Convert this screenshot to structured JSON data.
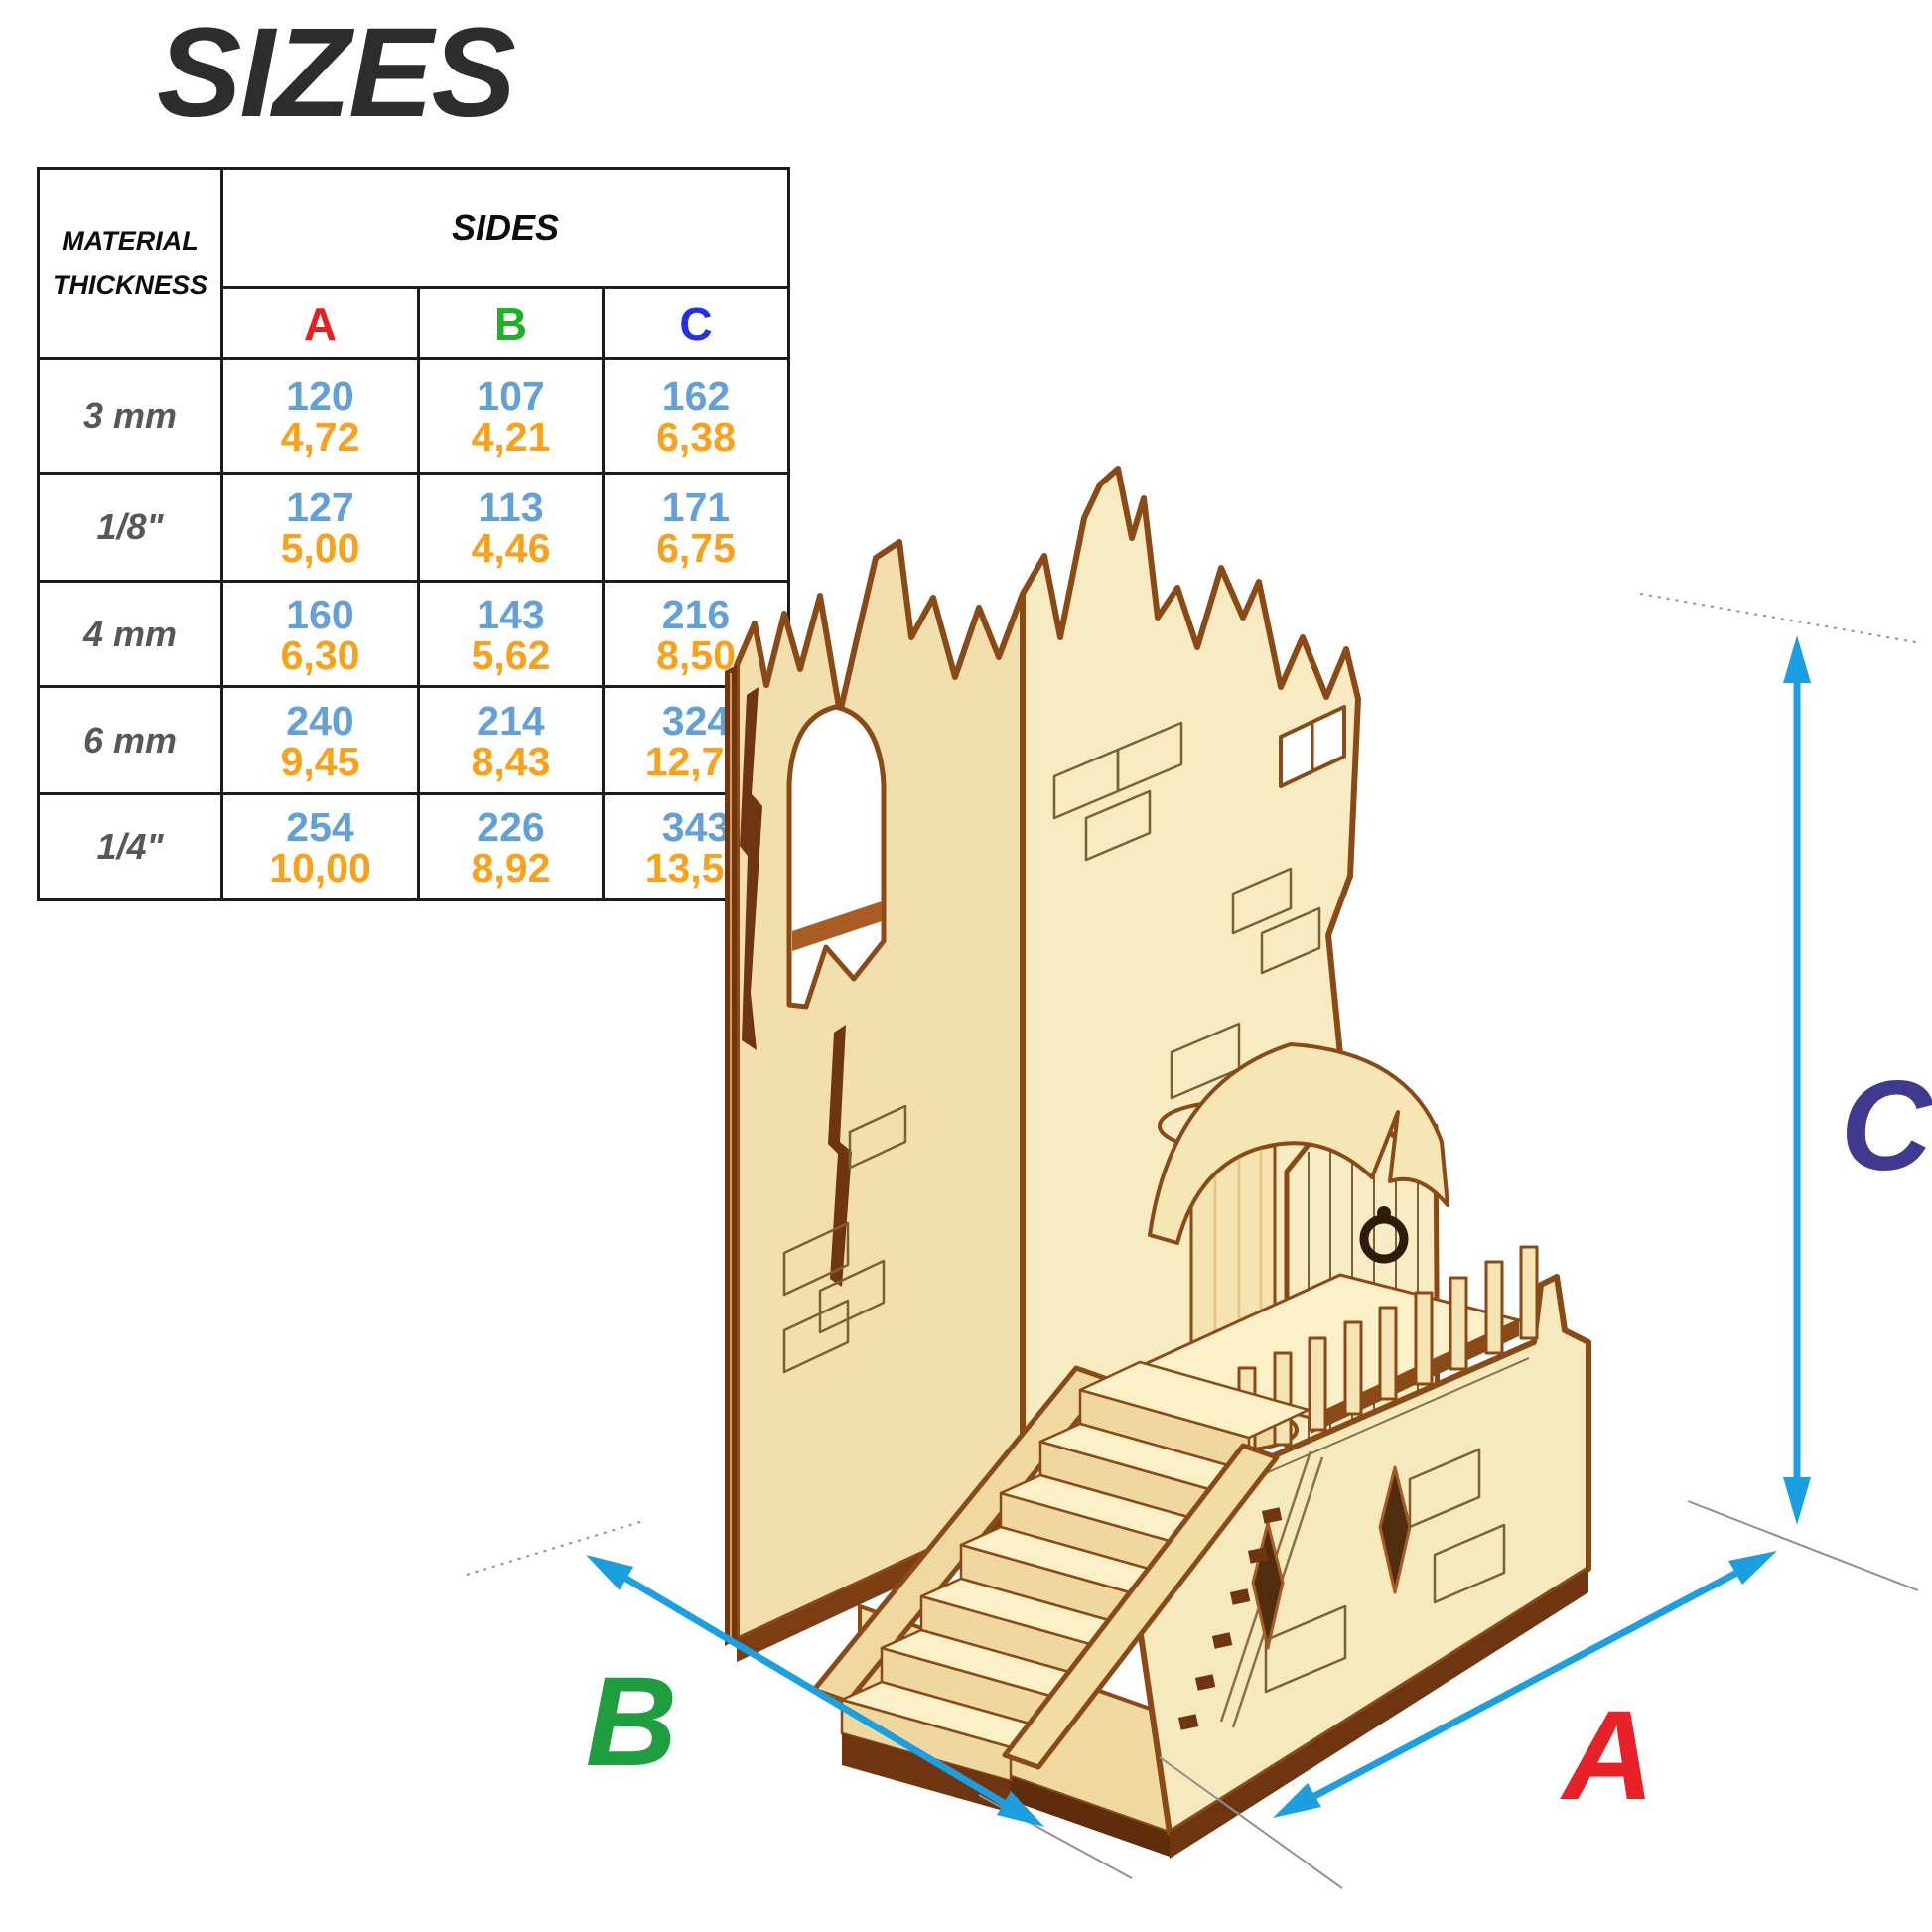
{
  "title": "SIZES",
  "table": {
    "corner_header": {
      "line1": "MATERIAL",
      "line2": "THICKNESS"
    },
    "sides_header": "SIDES",
    "columns": [
      {
        "key": "a",
        "label": "A",
        "color": "#EC1C24"
      },
      {
        "key": "b",
        "label": "B",
        "color": "#1DB224"
      },
      {
        "key": "c",
        "label": "C",
        "color": "#2430E8"
      }
    ],
    "rows": [
      {
        "thickness": "3 mm",
        "a": {
          "mm": "120",
          "inch": "4,72"
        },
        "b": {
          "mm": "107",
          "inch": "4,21"
        },
        "c": {
          "mm": "162",
          "inch": "6,38"
        }
      },
      {
        "thickness": "1/8\"",
        "a": {
          "mm": "127",
          "inch": "5,00"
        },
        "b": {
          "mm": "113",
          "inch": "4,46"
        },
        "c": {
          "mm": "171",
          "inch": "6,75"
        }
      },
      {
        "thickness": "4 mm",
        "a": {
          "mm": "160",
          "inch": "6,30"
        },
        "b": {
          "mm": "143",
          "inch": "5,62"
        },
        "c": {
          "mm": "216",
          "inch": "8,50"
        }
      },
      {
        "thickness": "6 mm",
        "a": {
          "mm": "240",
          "inch": "9,45"
        },
        "b": {
          "mm": "214",
          "inch": "8,43"
        },
        "c": {
          "mm": "324",
          "inch": "12,76"
        }
      },
      {
        "thickness": "1/4\"",
        "a": {
          "mm": "254",
          "inch": "10,00"
        },
        "b": {
          "mm": "226",
          "inch": "8,92"
        },
        "c": {
          "mm": "343",
          "inch": "13,50"
        }
      }
    ]
  },
  "dimension_labels": {
    "a": "A",
    "b": "B",
    "c": "C"
  },
  "colors": {
    "dimension_line": "#1B9FE0",
    "label_a": "#E62128",
    "label_b": "#1E9E3E",
    "label_c": "#3F3A8F",
    "mm_value": "#64A0D8",
    "inch_value": "#F9A11B",
    "plywood_face": "#F6E7BC",
    "plywood_edge": "#8A4A16"
  }
}
